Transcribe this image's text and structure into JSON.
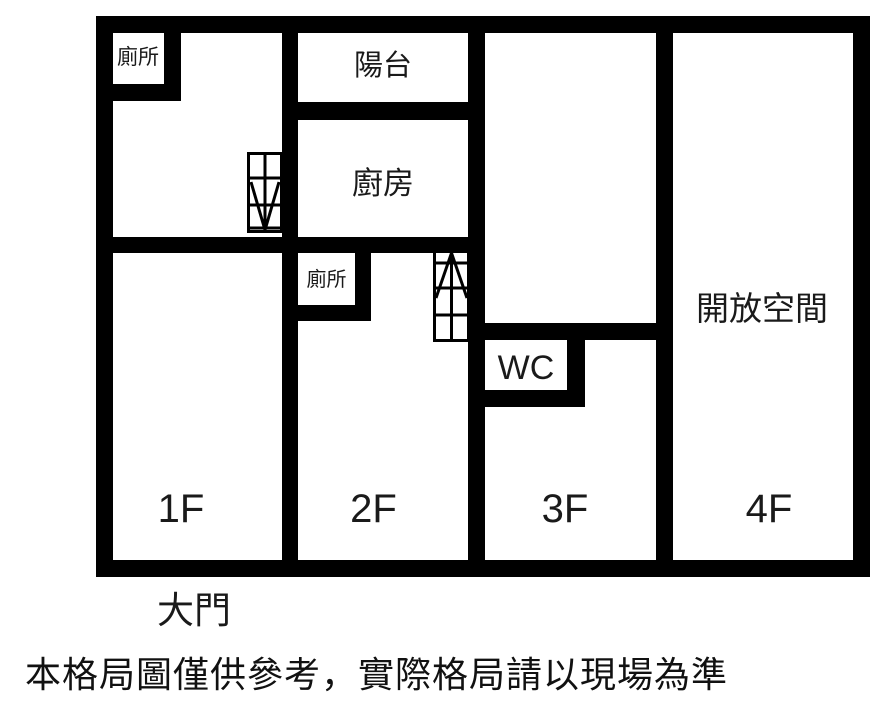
{
  "colors": {
    "wall": "#000000",
    "background": "#ffffff",
    "text": "#1a1a1a"
  },
  "floors": {
    "f1": {
      "label": "1F",
      "toilet": "廁所"
    },
    "f2": {
      "label": "2F",
      "balcony": "陽台",
      "kitchen": "廚房",
      "toilet": "廁所"
    },
    "f3": {
      "label": "3F",
      "wc": "WC"
    },
    "f4": {
      "label": "4F",
      "open_space": "開放空間"
    }
  },
  "entrance": "大門",
  "disclaimer": "本格局圖僅供參考，實際格局請以現場為準",
  "icons": {
    "stairs_down": "stairs-down-icon",
    "stairs_up": "stairs-up-icon"
  }
}
